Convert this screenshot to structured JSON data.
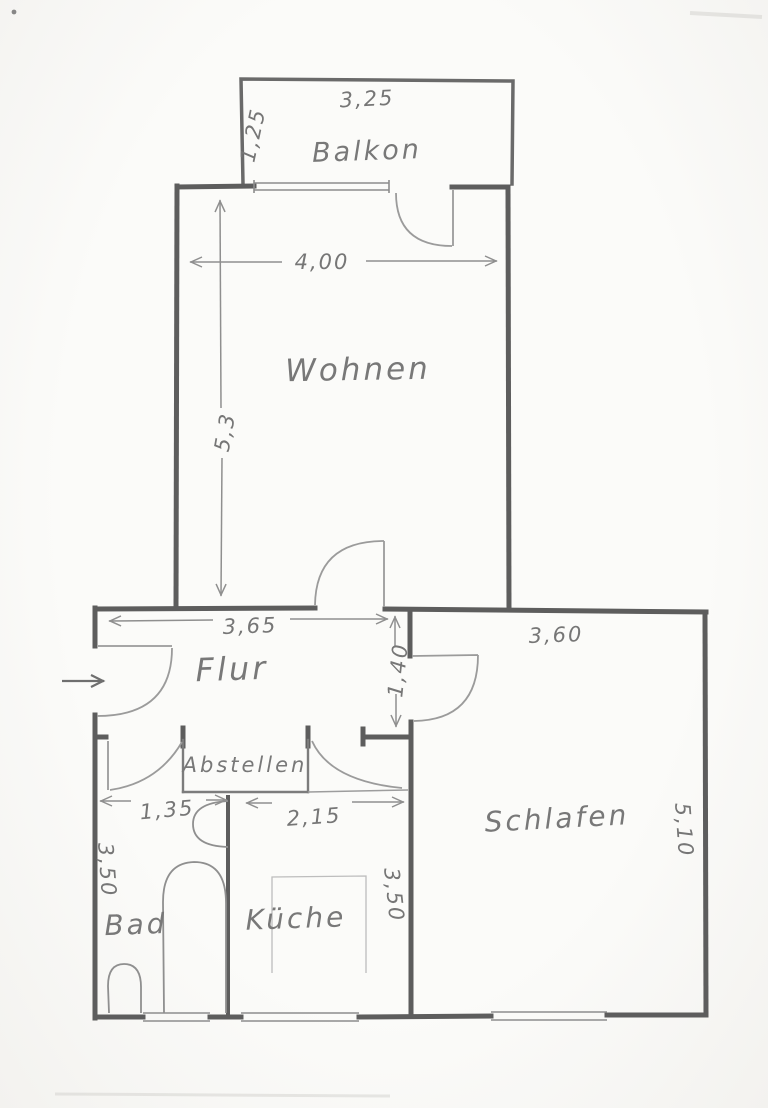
{
  "document": {
    "type": "hand-drawn apartment floor plan sketch",
    "colors": {
      "pencil": "#5d5d5d",
      "pencil_light": "#9b9b9b",
      "paper": "#fbfbf9"
    }
  },
  "rooms": {
    "balkon": "Balkon",
    "wohnen": "Wohnen",
    "flur": "Flur",
    "abstellen": "Abstellen",
    "schlafen": "Schlafen",
    "bad": "Bad",
    "kueche": "Küche"
  },
  "dims": {
    "balkon_width": "3,25",
    "balkon_depth": "1,25",
    "wohnen_width": "4,00",
    "wohnen_height": "5,3",
    "flur_width": "3,65",
    "schlafen_width": "3,60",
    "corridor_depth": "1,40",
    "bad_width": "1,35",
    "kueche_width": "2,15",
    "bad_height": "3,50",
    "kueche_height": "3,50",
    "schlafen_height": "5,10"
  }
}
